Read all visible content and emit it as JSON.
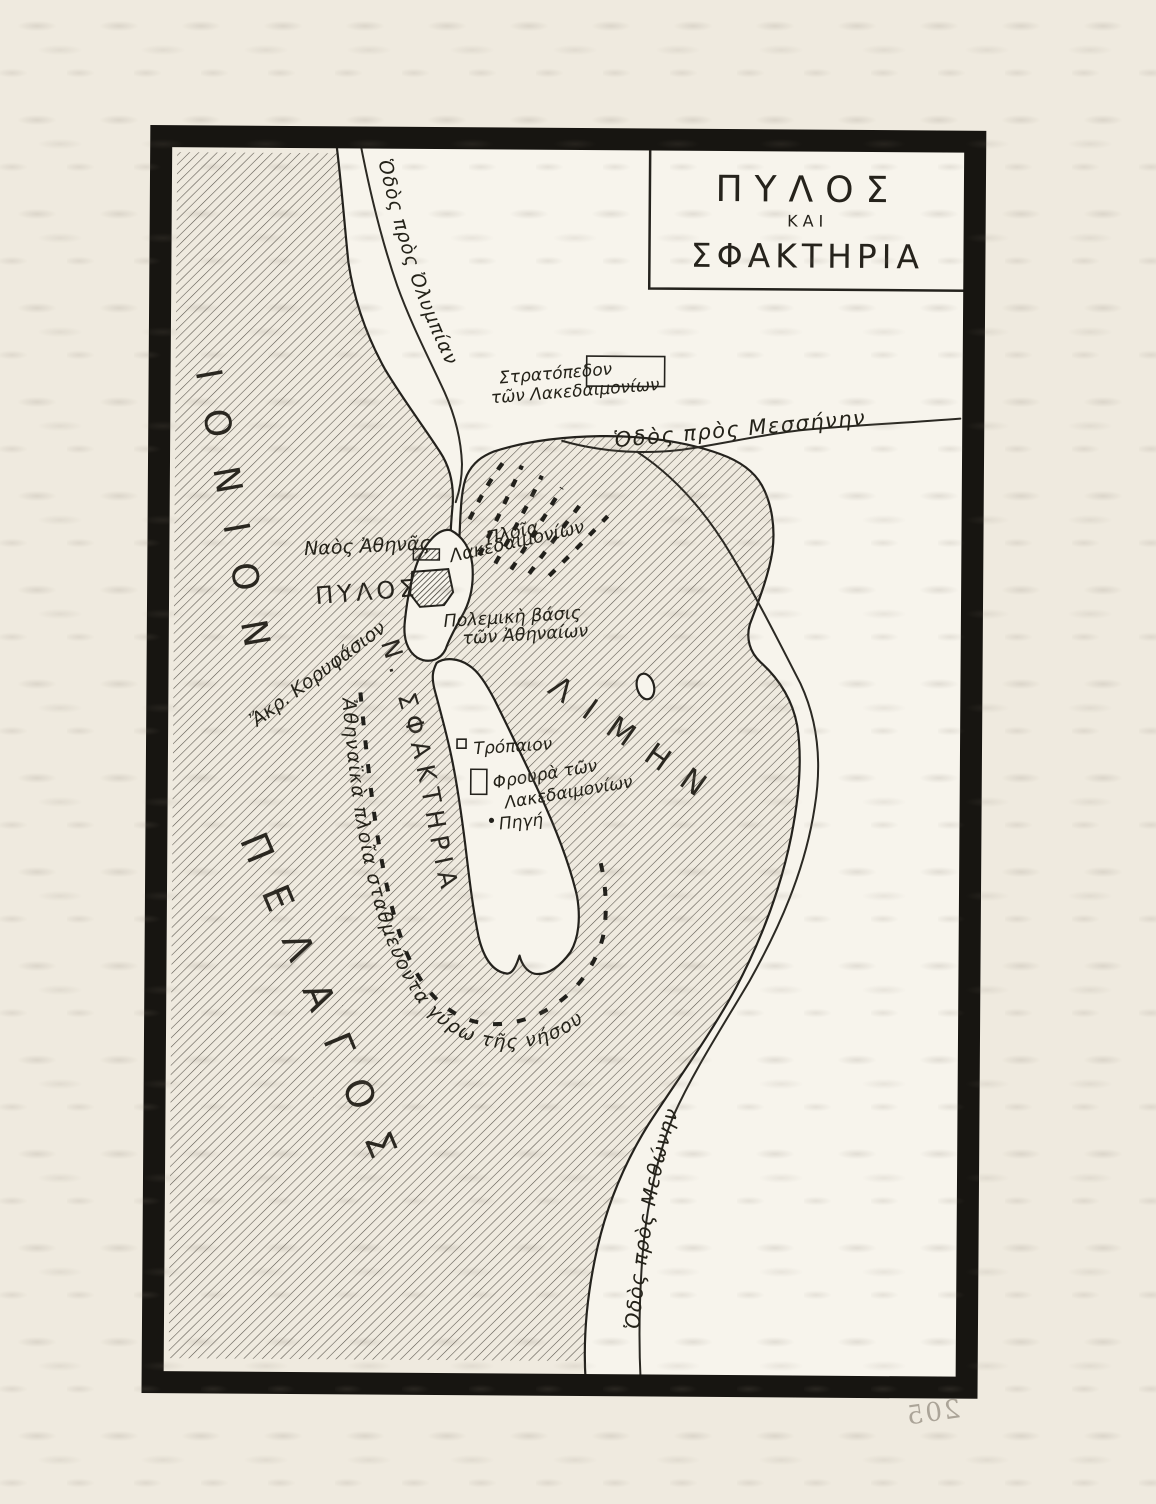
{
  "page": {
    "background": "#efeadf",
    "bleedthrough_page_number": "205"
  },
  "map": {
    "title": {
      "line1": "ΠΥΛΟΣ",
      "line2": "ΚΑΙ",
      "line3": "ΣΦΑΚΤΗΡΙΑ"
    },
    "sea": {
      "name_line1": "ΙΟΝΙΟΝ",
      "name_line2": "ΠΕΛΑΓΟΣ"
    },
    "harbor": {
      "name": "ΛΙΜΗΝ"
    },
    "island": {
      "name": "Ν. ΣΦΑΚΤΗΡΙΑ"
    },
    "roads": {
      "to_olympia": "Ὁδὸς πρὸς Ὀλυμπίαν",
      "to_messene": "Ὁδὸς πρὸς Μεσσήνην",
      "to_methone": "Ὁδὸς πρὸς Μεθώνην"
    },
    "places": {
      "spartan_camp_line1": "Στρατόπεδον",
      "spartan_camp_line2": "τῶν Λακεδαιμονίων",
      "athena_temple": "Ναὸς Ἀθηνᾶς",
      "pylos": "ΠΥΛΟΣ",
      "spartan_ships_line1": "Πλοῖα",
      "spartan_ships_line2": "Λακεδαιμονίων",
      "athenian_base_line1": "Πολεμικὴ βάσις",
      "athenian_base_line2": "τῶν Ἀθηναίων",
      "cape_koryphasion": "Ἄκρ. Κορυφάσιον",
      "trophy": "Τρόπαιον",
      "spartan_garrison_line1": "Φρουρὰ τῶν",
      "spartan_garrison_line2": "Λακεδαιμονίων",
      "spring": "Πηγή",
      "athenian_ships": "Ἀθηναϊκὰ πλοῖα σταθμεύοντα γύρω τῆς νήσου"
    },
    "symbols": {
      "spartan_camp": "rectangle-outline",
      "athena_temple": "hatched-rectangle",
      "pylos_fort": "hatched-polygon",
      "trophy": "small-square",
      "spartan_garrison": "rectangle-outline",
      "spring": "dot",
      "lacedaemonian_ships": "boat-marks-cluster",
      "athenian_ships": "boat-marks-line"
    },
    "colors": {
      "ink": "#24221d",
      "sea_hatch": "#5a564e",
      "paper": "#efeadf",
      "land": "#f7f4ec",
      "frame": "#171511"
    }
  }
}
